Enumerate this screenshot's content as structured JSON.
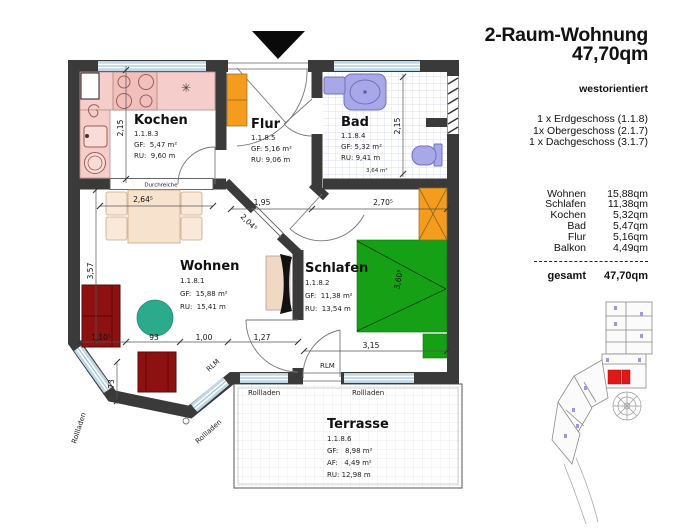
{
  "header": {
    "title1": "2-Raum-Wohnung",
    "title2": "47,70qm",
    "orientation": "westorientiert",
    "floors": [
      "1 x Erdgeschoss (1.1.8)",
      "1x Obergeschoss (2.1.7)",
      "1 x Dachgeschoss (3.1.7)"
    ]
  },
  "areas": {
    "rows": [
      {
        "name": "Wohnen",
        "value": "15,88qm"
      },
      {
        "name": "Schlafen",
        "value": "11,38qm"
      },
      {
        "name": "Kochen",
        "value": "5,32qm"
      },
      {
        "name": "Bad",
        "value": "5,47qm"
      },
      {
        "name": "Flur",
        "value": "5,16qm"
      },
      {
        "name": "Balkon",
        "value": "4,49qm"
      }
    ],
    "total_label": "gesamt",
    "total_value": "47,70qm"
  },
  "rooms": {
    "kochen": {
      "name": "Kochen",
      "id": "1.1.8.3",
      "gf": "GF:  5,47 m²",
      "ru": "RU:  9,60 m"
    },
    "flur": {
      "name": "Flur",
      "id": "1.1.8.5",
      "gf": "GF: 5,16 m²",
      "ru": "RU: 9,06 m"
    },
    "bad": {
      "name": "Bad",
      "id": "1.1.8.4",
      "gf": "GF: 5,32 m²",
      "ru": "RU: 9,41 m",
      "niche_area": "3,64 m²"
    },
    "wohnen": {
      "name": "Wohnen",
      "id": "1.1.8.1",
      "gf": "GF:  15,88 m²",
      "ru": "RU:  15,41 m"
    },
    "schlafen": {
      "name": "Schlafen",
      "id": "1.1.8.2",
      "gf": "GF:  11,38 m²",
      "ru": "RU:  13,54 m"
    },
    "terrasse": {
      "name": "Terrasse",
      "id": "1.1.8.6",
      "gf": "GF:   8,98 m²",
      "af": "AF:   4,49 m²",
      "ru": "RU: 12,98 m"
    }
  },
  "dims": {
    "k215": "2,15",
    "b215": "2,15",
    "t264": "2,64⁵",
    "f195": "1,95",
    "s270": "2,70⁵",
    "d204": "2,04⁵",
    "w357": "3,57",
    "s110": "1,10⁵",
    "d93": "93",
    "d100": "1,00",
    "d127": "1,27",
    "d73": "73",
    "bed360": "3,60⁵",
    "s315": "3,15"
  },
  "labels": {
    "durchreiche": "Durchreiche",
    "rollladen": "Rollladen",
    "rlm": "RLM",
    "star": "✳"
  },
  "colors": {
    "wall": "#3a3a3a",
    "kitchen_pink": "#f5cdca",
    "bath_lavender": "#a8a8e8",
    "window_blue": "#bdd8ea",
    "furniture_red": "#8e1111",
    "bed_green": "#15a015",
    "table_teal": "#2bab8b",
    "wardrobe_orange": "#f59b1e",
    "table_beige": "#f6e2cd",
    "site_unit_red": "#e01818"
  }
}
